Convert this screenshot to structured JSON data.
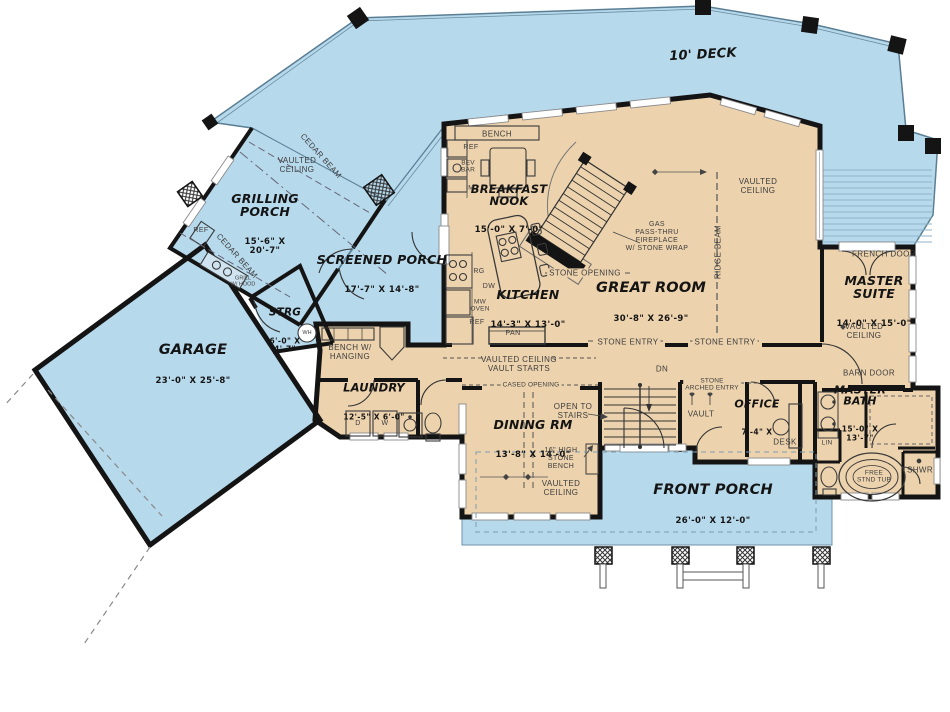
{
  "colors": {
    "floor_tan": "#ecd2ad",
    "outdoor_blue": "#b7d9ec",
    "wall_black": "#141414"
  },
  "rooms": {
    "deck": {
      "name": "10' DECK"
    },
    "grilling_porch": {
      "name": "GRILLING\nPORCH",
      "dims": "15'-6\" X\n20'-7\""
    },
    "screened_porch": {
      "name": "SCREENED PORCH",
      "dims": "17'-7\" X 14'-8\""
    },
    "garage": {
      "name": "GARAGE",
      "dims": "23'-0\" X 25'-8\""
    },
    "strg": {
      "name": "STRG",
      "dims": "6'-0\" X\n4'-7\""
    },
    "breakfast_nook": {
      "name": "BREAKFAST\nNOOK",
      "dims": "15'-0\" X 7'-0\""
    },
    "kitchen": {
      "name": "KITCHEN",
      "dims": "14'-3\" X 13'-0\""
    },
    "great_room": {
      "name": "GREAT ROOM",
      "dims": "30'-8\" X 26'-9\""
    },
    "master_suite": {
      "name": "MASTER SUITE",
      "dims": "14'-0\" X 15'-0\""
    },
    "master_bath": {
      "name": "MASTER\nBATH",
      "dims": "15'-0\" X\n13'-7\""
    },
    "office": {
      "name": "OFFICE",
      "dims": "7'-4\" X"
    },
    "laundry": {
      "name": "LAUNDRY",
      "dims": "12'-5\" X 6'-0\""
    },
    "dining_room": {
      "name": "DINING RM",
      "dims": "13'-8\" X 14'-0\""
    },
    "front_porch": {
      "name": "FRONT PORCH",
      "dims": "26'-0\" X 12'-0\""
    }
  },
  "labels": {
    "bench": "BENCH",
    "ref_top": "REF",
    "bev_bar": "BEV\nBAR",
    "ice_maker": "IM",
    "range": "RG",
    "dishwasher": "DW",
    "mw_oven": "MW\nOVEN",
    "ref_kitchen": "REF",
    "pantry": "PAN",
    "stone_opening": "STONE OPENING",
    "fireplace": "GAS\nPASS-THRU\nFIREPLACE\nW/ STONE WRAP",
    "ridge_beam": "RIDGE BEAM",
    "vaulted_ceiling_great": "VAULTED\nCEILING",
    "vaulted_ceiling_grilling": "VAULTED\nCEILING",
    "vaulted_ceiling_master": "VAULTED\nCEILING",
    "vaulted_ceiling_dining": "VAULTED\nCEILING",
    "vaulted_ceiling_hall": "VAULTED CEILING\nVAULT STARTS",
    "cedar_beam_upper": "CEDAR BEAM",
    "cedar_beam_lower": "CEDAR BEAM",
    "ref_grilling": "REF",
    "grill_hood": "GRILL\nW/ HOOD",
    "french_door": "FRENCH DOOR",
    "barn_door": "BARN DOOR",
    "stone_entry_left": "STONE ENTRY",
    "stone_entry_right": "STONE ENTRY",
    "cased_opening": "CASED OPENING",
    "open_to_stairs": "OPEN TO\nSTAIRS",
    "down": "DN",
    "stone_arched_entry": "STONE\nARCHED ENTRY",
    "vault": "VAULT",
    "desk": "DESK",
    "linen": "LIN",
    "stone_bench": "16\" HIGH\nSTONE\nBENCH",
    "bench_hanging": "BENCH W/\nHANGING",
    "shower": "SHWR",
    "tub": "FREE\nSTND TUB",
    "water_heater": "WH",
    "dryer": "D",
    "washer": "W"
  }
}
